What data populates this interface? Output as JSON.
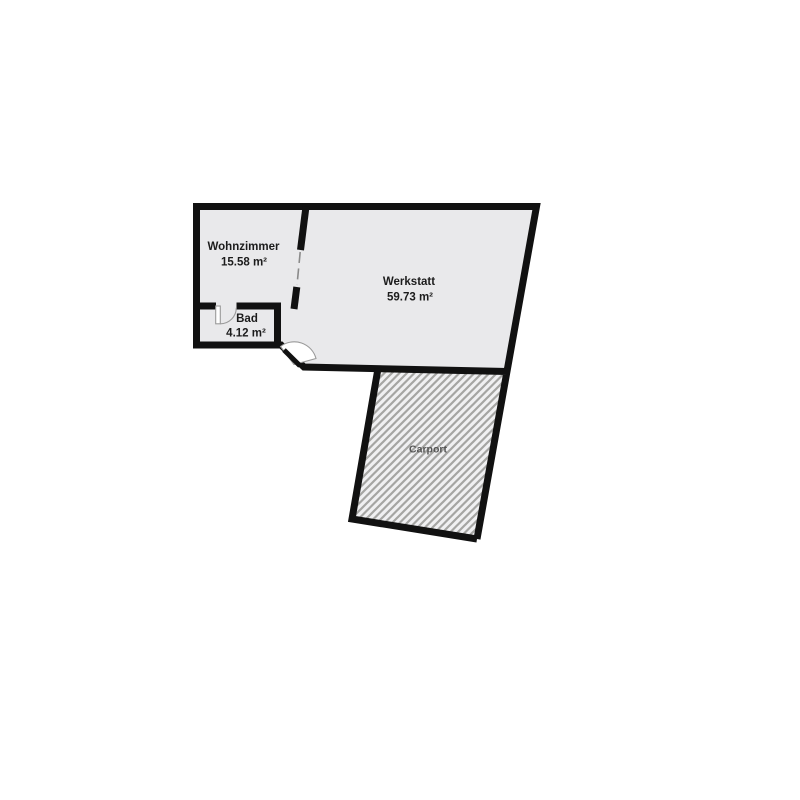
{
  "rooms": {
    "wohnzimmer": {
      "name": "Wohnzimmer",
      "area": "15.58 m²"
    },
    "bad": {
      "name": "Bad",
      "area": "4.12 m²"
    },
    "werkstatt": {
      "name": "Werkstatt",
      "area": "59.73 m²"
    },
    "carport": {
      "name": "Carport"
    }
  },
  "colors": {
    "background": "#ffffff",
    "wall": "#111111",
    "room_fill": "#e9e9eb",
    "carport_fill": "#f0f0f2",
    "hatch_stripe": "#a5a5a3",
    "opening_dash": "#8a8a8a",
    "door_outline": "#9a9a9a",
    "label_text": "#1c1c1c",
    "carport_label_text": "#555555"
  }
}
